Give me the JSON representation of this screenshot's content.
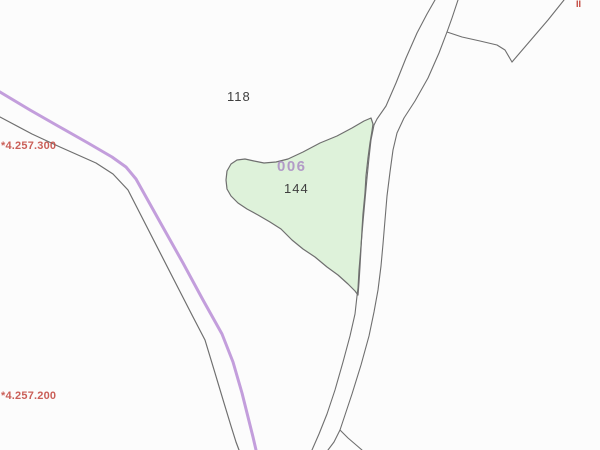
{
  "map": {
    "background": "#fcfcfc",
    "colors": {
      "parcel_fill": "#def2da",
      "boundary_line": "#6f6f6f",
      "highlight_line": "#bd93d8",
      "grid_label": "#c2443c",
      "parcel_code_label": "#ab8cc4",
      "parcel_number_label": "#3f3f3f"
    },
    "labels": {
      "neighbor_parcel_118": {
        "text": "118",
        "x": 227,
        "y": 90,
        "color": "#3f3f3f"
      },
      "parcel_code_006": {
        "text": "006",
        "x": 277,
        "y": 159,
        "color": "#ab8cc4"
      },
      "parcel_number_144": {
        "text": "144",
        "x": 284,
        "y": 182,
        "color": "#3f3f3f"
      },
      "grid_northing_4257300": {
        "text": "*4.257.300",
        "x": 1,
        "y": 141,
        "color": "#c2443c"
      },
      "grid_northing_4257200": {
        "text": "*4.257.200",
        "x": 1,
        "y": 391,
        "color": "#c2443c"
      },
      "edge_label_fragment": {
        "text": "II",
        "x": 576,
        "y": 0,
        "color": "#c2443c"
      }
    },
    "parcel": {
      "code": "006",
      "number": "144",
      "fill": "#def2da",
      "stroke": "#6f6f6f",
      "stroke_width": 1.2,
      "points": [
        [
          371,
          118
        ],
        [
          364,
          121
        ],
        [
          352,
          128
        ],
        [
          337,
          136
        ],
        [
          320,
          143
        ],
        [
          303,
          152
        ],
        [
          288,
          159
        ],
        [
          276,
          162
        ],
        [
          264,
          163
        ],
        [
          254,
          161
        ],
        [
          245,
          159
        ],
        [
          237,
          160
        ],
        [
          231,
          164
        ],
        [
          227,
          171
        ],
        [
          226,
          180
        ],
        [
          227,
          189
        ],
        [
          231,
          196
        ],
        [
          238,
          203
        ],
        [
          247,
          209
        ],
        [
          258,
          215
        ],
        [
          270,
          222
        ],
        [
          281,
          229
        ],
        [
          292,
          240
        ],
        [
          303,
          249
        ],
        [
          315,
          257
        ],
        [
          327,
          267
        ],
        [
          338,
          275
        ],
        [
          348,
          284
        ],
        [
          355,
          291
        ],
        [
          358,
          295
        ],
        [
          359,
          282
        ],
        [
          360,
          266
        ],
        [
          361,
          248
        ],
        [
          362,
          230
        ],
        [
          363,
          214
        ],
        [
          365,
          193
        ],
        [
          366,
          176
        ],
        [
          368,
          158
        ],
        [
          370,
          143
        ],
        [
          372,
          131
        ],
        [
          373,
          124
        ]
      ]
    },
    "lines": [
      {
        "name": "highlight-route-line",
        "color": "#bd93d8",
        "width": 3,
        "opacity": 0.9,
        "points": [
          [
            0,
            92
          ],
          [
            30,
            110
          ],
          [
            58,
            126
          ],
          [
            88,
            143
          ],
          [
            112,
            157
          ],
          [
            126,
            167
          ],
          [
            136,
            179
          ],
          [
            160,
            222
          ],
          [
            183,
            263
          ],
          [
            203,
            300
          ],
          [
            222,
            334
          ],
          [
            233,
            362
          ],
          [
            242,
            393
          ],
          [
            249,
            421
          ],
          [
            253,
            437
          ],
          [
            256,
            450
          ]
        ]
      },
      {
        "name": "boundary-line-southwest",
        "color": "#6f6f6f",
        "width": 1.2,
        "opacity": 1,
        "points": [
          [
            0,
            117
          ],
          [
            32,
            134
          ],
          [
            60,
            147
          ],
          [
            96,
            163
          ],
          [
            113,
            174
          ],
          [
            128,
            190
          ],
          [
            150,
            233
          ],
          [
            172,
            276
          ],
          [
            192,
            315
          ],
          [
            205,
            340
          ],
          [
            215,
            373
          ],
          [
            224,
            403
          ],
          [
            231,
            426
          ],
          [
            236,
            442
          ],
          [
            239,
            450
          ]
        ]
      },
      {
        "name": "road-edge-left",
        "color": "#6f6f6f",
        "width": 1.1,
        "opacity": 1,
        "points": [
          [
            435,
            0
          ],
          [
            427,
            14
          ],
          [
            417,
            33
          ],
          [
            406,
            58
          ],
          [
            396,
            83
          ],
          [
            386,
            106
          ],
          [
            377,
            119
          ],
          [
            374,
            125
          ],
          [
            371,
            140
          ],
          [
            369,
            158
          ],
          [
            367,
            178
          ],
          [
            365,
            200
          ],
          [
            363,
            222
          ],
          [
            361,
            246
          ],
          [
            359,
            270
          ],
          [
            358,
            288
          ],
          [
            357,
            296
          ],
          [
            355,
            314
          ],
          [
            350,
            336
          ],
          [
            343,
            362
          ],
          [
            335,
            390
          ],
          [
            327,
            414
          ],
          [
            319,
            434
          ],
          [
            312,
            450
          ]
        ]
      },
      {
        "name": "road-edge-right",
        "color": "#6f6f6f",
        "width": 1.1,
        "opacity": 1,
        "points": [
          [
            458,
            0
          ],
          [
            452,
            18
          ],
          [
            447,
            32
          ],
          [
            439,
            53
          ],
          [
            428,
            78
          ],
          [
            415,
            101
          ],
          [
            404,
            118
          ],
          [
            397,
            133
          ],
          [
            393,
            150
          ],
          [
            390,
            172
          ],
          [
            387,
            196
          ],
          [
            385,
            220
          ],
          [
            383,
            244
          ],
          [
            381,
            266
          ],
          [
            378,
            290
          ],
          [
            374,
            312
          ],
          [
            369,
            336
          ],
          [
            361,
            365
          ],
          [
            352,
            394
          ],
          [
            345,
            415
          ],
          [
            340,
            430
          ],
          [
            334,
            442
          ],
          [
            328,
            450
          ]
        ]
      },
      {
        "name": "road-fork-branch",
        "color": "#6f6f6f",
        "width": 1.1,
        "opacity": 1,
        "points": [
          [
            340,
            430
          ],
          [
            348,
            438
          ],
          [
            355,
            444
          ],
          [
            362,
            450
          ]
        ]
      },
      {
        "name": "boundary-branch-top-right",
        "color": "#6f6f6f",
        "width": 1.1,
        "opacity": 1,
        "points": [
          [
            447,
            32
          ],
          [
            462,
            37
          ],
          [
            480,
            41
          ],
          [
            497,
            45
          ],
          [
            505,
            50
          ],
          [
            512,
            62
          ]
        ]
      },
      {
        "name": "boundary-corner-top-right",
        "color": "#6f6f6f",
        "width": 1.1,
        "opacity": 1,
        "points": [
          [
            512,
            62
          ],
          [
            530,
            41
          ],
          [
            548,
            20
          ],
          [
            564,
            0
          ]
        ]
      }
    ]
  }
}
